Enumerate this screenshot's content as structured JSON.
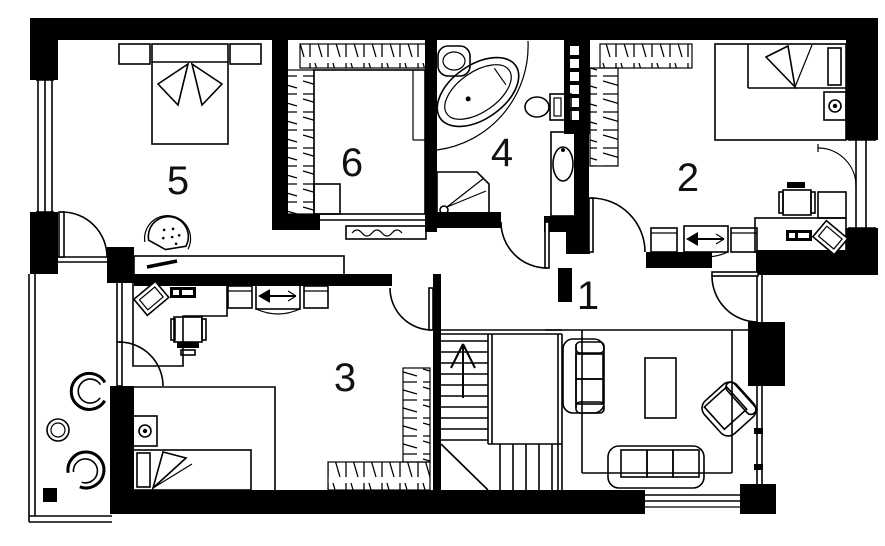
{
  "diagram": {
    "type": "floor-plan",
    "level": "apartment-upper-floor"
  },
  "rooms": {
    "room1": "1",
    "room2": "2",
    "room3": "3",
    "room4": "4",
    "room5": "5",
    "room6": "6"
  },
  "colors": {
    "walls": "#000000",
    "background": "#ffffff"
  }
}
